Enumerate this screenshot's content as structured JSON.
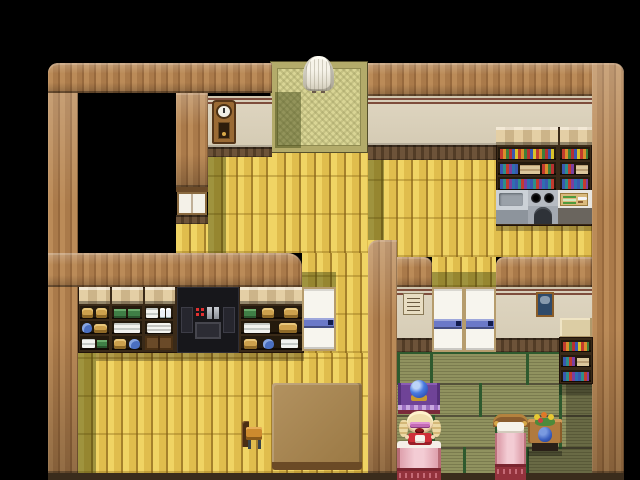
{
  "scene": {
    "title": "Top-down RPG house interior",
    "style": "16-bit tile RPG interior (wooden house with kitchen and tatami bedroom)",
    "rooms": {
      "entry": "Entry corridor with straw mat",
      "storage": "Dark unexplored opening",
      "kitchen": "Kitchen with counters and black range",
      "pantry": "Upper-right kitchen nook with shelves, sink and stove",
      "bedroom": "Tatami bedroom with two beds"
    }
  },
  "palette": {
    "wall_wood": "#aa7a4a",
    "floor_plank": "#e0bd4d",
    "tatami_green": "#90925f",
    "mat_straw": "#d9d595",
    "wall_plaster": "#d8cfba",
    "wainscot": "#5f4831",
    "shoji_white": "#f7f5ee",
    "shoji_band_blue": "#6b79c8",
    "bed_pink": "#ecb9c2",
    "bed_frill_red": "#93323c",
    "fortune_table_purple": "#6f4397",
    "crystal_blue": "#3a66d6",
    "shadow_olive": "rgba(48,58,10,0.42)",
    "void_black": "#000000"
  },
  "entities": {
    "visitor": {
      "label": "White-haired visitor standing on entry mat"
    },
    "void": {
      "label": "Dark opening in floor plan"
    },
    "clock": {
      "label": "Grandfather clock"
    },
    "wall_shoji": {
      "label": "Small shoji panel at wall end"
    },
    "entry_mat": {
      "label": "Woven entry mat"
    },
    "pantry_shelf_a": {
      "label": "Shelf of books and jars"
    },
    "pantry_shelf_b": {
      "label": "Shelf of books and jars"
    },
    "sink": {
      "label": "Kitchen sink"
    },
    "stove": {
      "label": "Two-burner stove"
    },
    "cutting_board": {
      "label": "Cutting board with leeks and knife"
    },
    "kitchen_counter": {
      "label": "Kitchen counter with baskets, towels and crockery"
    },
    "black_range": {
      "label": "Black kitchen range with red indicator lights"
    },
    "kitchen_door": {
      "label": "White sliding door"
    },
    "dining_table": {
      "label": "Large wooden table"
    },
    "chair": {
      "label": "Wooden chair"
    },
    "bedroom_door_left": {
      "label": "Sliding door (left panel)"
    },
    "bedroom_door_right": {
      "label": "Sliding door (right panel)"
    },
    "wall_note": {
      "label": "Pinned note with small writing"
    },
    "picture": {
      "label": "Framed picture"
    },
    "wall_scroll": {
      "label": "Tan paper on wall"
    },
    "bedroom_bookshelf": {
      "label": "Bookshelf with books and scrolls"
    },
    "fortune_table": {
      "label": "Purple-draped table"
    },
    "crystal_ball": {
      "label": "Blue crystal ball"
    },
    "sleeping_girl": {
      "label": "Blonde girl wearing an eye mask"
    },
    "bed_left": {
      "label": "Pink bed"
    },
    "bed_right": {
      "label": "Pink bed with headboard and pillow"
    },
    "flower_table": {
      "label": "Side table with flower vase"
    }
  }
}
